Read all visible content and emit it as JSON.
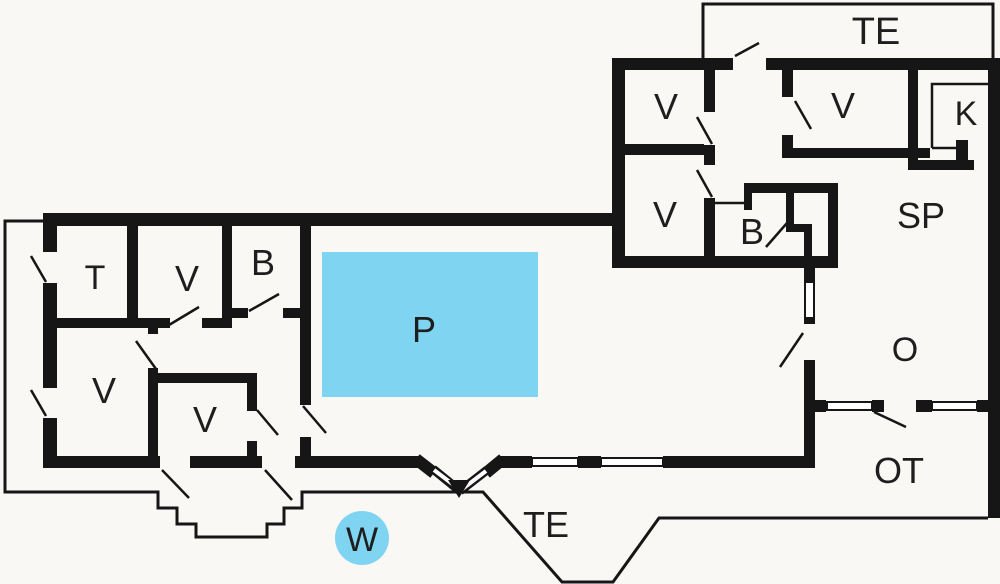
{
  "plan": {
    "title": "Holiday house floor plan",
    "colors": {
      "wall": "#161616",
      "background": "#f9f8f5",
      "pool": "#7fd4f1",
      "label": "#1e1e1e"
    },
    "rooms": [
      {
        "id": "terrace-top",
        "label": "TE"
      },
      {
        "id": "bedroom-nw",
        "label": "V"
      },
      {
        "id": "bedroom-ne",
        "label": "V"
      },
      {
        "id": "kitchen",
        "label": "K"
      },
      {
        "id": "bedroom-w2",
        "label": "V"
      },
      {
        "id": "bath-upper",
        "label": "B"
      },
      {
        "id": "dining",
        "label": "SP"
      },
      {
        "id": "toilet",
        "label": "T"
      },
      {
        "id": "bedroom-top",
        "label": "V"
      },
      {
        "id": "bath-main",
        "label": "B"
      },
      {
        "id": "pool",
        "label": "P"
      },
      {
        "id": "bedroom-big",
        "label": "V"
      },
      {
        "id": "bedroom-small",
        "label": "V"
      },
      {
        "id": "livingroom",
        "label": "O"
      },
      {
        "id": "outbuilding",
        "label": "OT"
      },
      {
        "id": "terrace-bottom",
        "label": "TE"
      },
      {
        "id": "whirlpool",
        "label": "W"
      }
    ]
  }
}
